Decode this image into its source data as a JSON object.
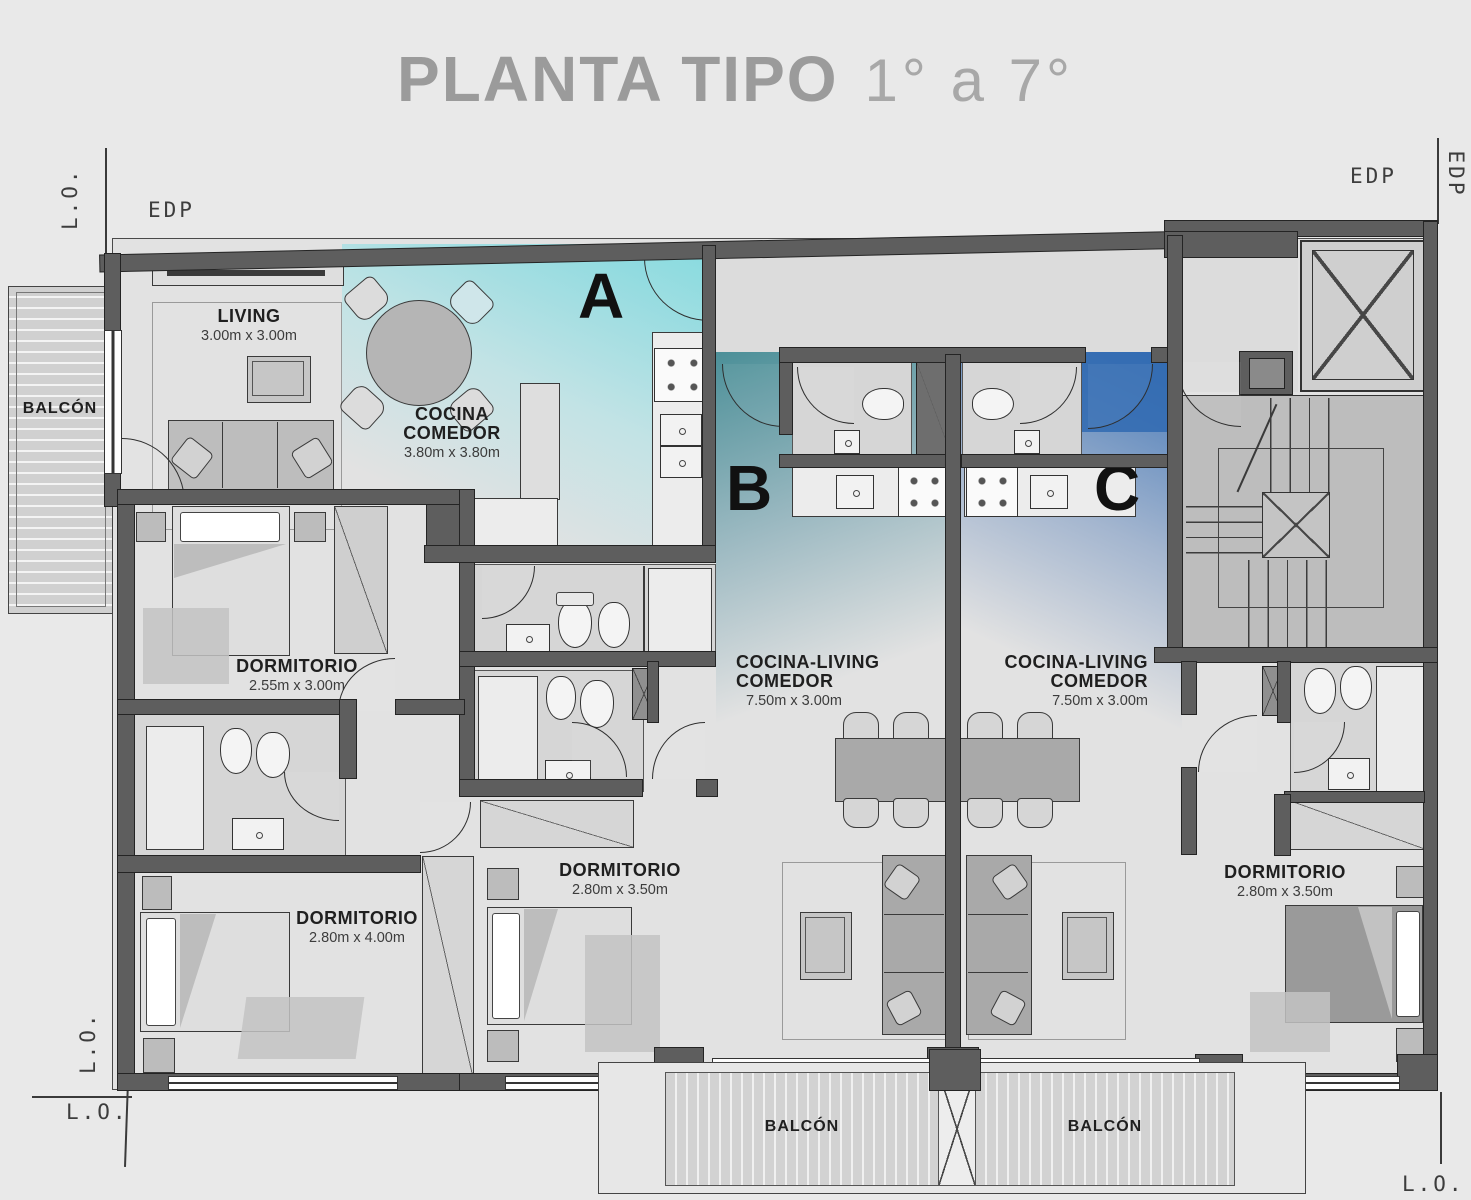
{
  "title": {
    "main": "PLANTA TIPO",
    "range": "1° a 7°"
  },
  "site": {
    "edp_left": "EDP",
    "edp_right": "EDP",
    "edp_right_vertical": "EDP",
    "lo_top_left_vertical": "L.O.",
    "lo_bottom_left_vertical": "L.O.",
    "lo_bottom_left": "L.O.",
    "lo_bottom_right": "L.O."
  },
  "units": {
    "a": "A",
    "b": "B",
    "c": "C"
  },
  "rooms": {
    "balcon_left": {
      "label": "BALCÓN"
    },
    "living": {
      "label": "LIVING",
      "dims": "3.00m x 3.00m"
    },
    "cocina_comedor": {
      "line1": "COCINA",
      "line2": "COMEDOR",
      "dims": "3.80m x 3.80m"
    },
    "dormitorio_a1": {
      "label": "DORMITORIO",
      "dims": "2.55m x 3.00m"
    },
    "dormitorio_a2": {
      "label": "DORMITORIO",
      "dims": "2.80m x 4.00m"
    },
    "dormitorio_a3": {
      "label": "DORMITORIO",
      "dims": "2.80m x 3.50m"
    },
    "cocina_living_b": {
      "line1": "COCINA-LIVING",
      "line2": "COMEDOR",
      "dims": "7.50m x 3.00m"
    },
    "cocina_living_c": {
      "line1": "COCINA-LIVING",
      "line2": "COMEDOR",
      "dims": "7.50m x 3.00m"
    },
    "dormitorio_c": {
      "label": "DORMITORIO",
      "dims": "2.80m x 3.50m"
    },
    "balcon_b": {
      "label": "BALCÓN"
    },
    "balcon_c": {
      "label": "BALCÓN"
    }
  },
  "colors": {
    "tint_a": "#bfeaec",
    "tint_b": "#4f98a0",
    "tint_c": "#3a74b9",
    "wall": "#5e5e5e",
    "title": "#9b9b9b"
  }
}
